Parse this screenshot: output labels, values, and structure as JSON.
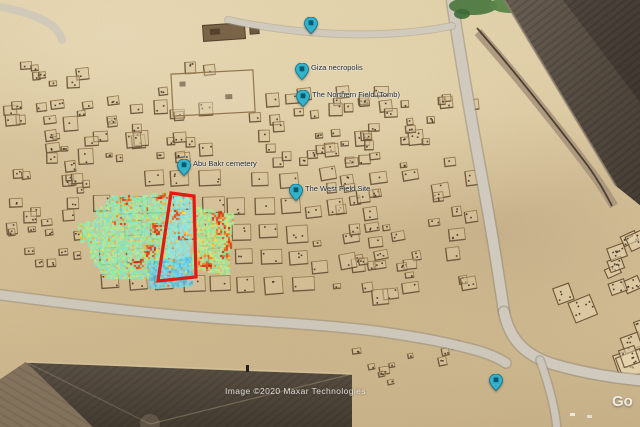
{
  "app": {
    "title": "Aerial view of the Giza plateau with geophysical survey overlay",
    "attribution": "Image ©2020 Maxar Technologies",
    "watermark_partial": "Go"
  },
  "colors": {
    "sand": "#d7c39a",
    "survey_outline": "#e51a14",
    "pin_fill": "#33b4cc",
    "pin_stroke": "#0d7490",
    "pin_glyph": "#0a5a72",
    "road": "#d3cdc1",
    "pyramid_dark": "#564c42",
    "heat_hot": [
      "#ffe33e",
      "#ffb01e",
      "#ff7a10",
      "#f23d0a",
      "#d41703"
    ]
  },
  "pins": [
    {
      "label": "",
      "x": 311,
      "y": 33
    },
    {
      "label": "Giza necropolis",
      "x": 302,
      "y": 79
    },
    {
      "label": "The Northern Field (Tomb)",
      "x": 303,
      "y": 106
    },
    {
      "label": "Abu Bakr cemetery",
      "x": 184,
      "y": 175
    },
    {
      "label": "The West Field Site",
      "x": 296,
      "y": 200
    },
    {
      "label": "",
      "x": 496,
      "y": 390
    }
  ],
  "scene": {
    "seed": 7,
    "survey_outline_points": [
      [
        171,
        193
      ],
      [
        194,
        196
      ],
      [
        196,
        277
      ],
      [
        158,
        281
      ]
    ],
    "heatmap_patches": [
      {
        "poly": [
          [
            113,
            196
          ],
          [
            171,
            193
          ],
          [
            170,
            266
          ],
          [
            152,
            267
          ],
          [
            150,
            280
          ],
          [
            106,
            279
          ],
          [
            90,
            258
          ],
          [
            88,
            235
          ],
          [
            97,
            210
          ]
        ],
        "base": [
          "#8ceea2",
          "#9df2ae",
          "#7fe9d6",
          "#b2f2a0"
        ],
        "base_hot": 0.06,
        "boost": 0.5,
        "clusters": [
          [
            156,
            228
          ],
          [
            149,
            250
          ],
          [
            126,
            197
          ],
          [
            160,
            196
          ],
          [
            136,
            262
          ],
          [
            118,
            221
          ]
        ]
      },
      {
        "poly": [
          [
            171,
            196
          ],
          [
            193,
            198
          ],
          [
            190,
            271
          ],
          [
            166,
            268
          ]
        ],
        "base": [
          "#7fe9ea",
          "#8defe3",
          "#9ef2d2",
          "#8be4ef"
        ],
        "base_hot": 0.05,
        "boost": 0.3,
        "clusters": [
          [
            180,
            236
          ],
          [
            175,
            214
          ]
        ]
      },
      {
        "poly": [
          [
            147,
            261
          ],
          [
            195,
            257
          ],
          [
            192,
            286
          ],
          [
            149,
            289
          ]
        ],
        "base": [
          "#46bce2",
          "#58cae9",
          "#6cd6ee",
          "#7fe0f0"
        ],
        "base_hot": 0.04,
        "boost": 0.22,
        "clusters": [
          [
            170,
            272
          ]
        ]
      },
      {
        "poly": [
          [
            196,
            207
          ],
          [
            234,
            214
          ],
          [
            229,
            276
          ],
          [
            192,
            269
          ]
        ],
        "base": [
          "#8ceea2",
          "#aff09b",
          "#c8f08c"
        ],
        "base_hot": 0.14,
        "boost": 0.55,
        "clusters": [
          [
            222,
            230
          ],
          [
            226,
            255
          ],
          [
            205,
            262
          ],
          [
            218,
            216
          ],
          [
            230,
            243
          ]
        ]
      },
      {
        "poly": [
          [
            78,
            224
          ],
          [
            90,
            221
          ],
          [
            92,
            240
          ],
          [
            80,
            243
          ]
        ],
        "base": [
          "#8ceea2",
          "#9df2ae"
        ],
        "base_hot": 0.03,
        "boost": 0.2,
        "clusters": [
          [
            85,
            232
          ]
        ]
      }
    ],
    "mastaba_clusters": [
      {
        "type": "grid",
        "x": 90,
        "y": 170,
        "cols": 8,
        "rows": 5,
        "dx": 27,
        "dy": 26,
        "w": 19,
        "h": 15,
        "rot": -3,
        "row_shift": 3,
        "skip": 0.12
      },
      {
        "type": "scatter",
        "x": 2,
        "y": 58,
        "w": 225,
        "h": 100,
        "count": 48,
        "min": 6,
        "max": 15,
        "rot": -5
      },
      {
        "type": "scatter",
        "x": 2,
        "y": 150,
        "w": 82,
        "h": 112,
        "count": 26,
        "min": 6,
        "max": 13,
        "rot": -4
      },
      {
        "type": "scatter",
        "x": 232,
        "y": 84,
        "w": 235,
        "h": 80,
        "count": 52,
        "min": 6,
        "max": 15,
        "rot": -4
      },
      {
        "type": "scatter",
        "x": 305,
        "y": 165,
        "w": 162,
        "h": 130,
        "count": 48,
        "min": 7,
        "max": 17,
        "rot": -8
      },
      {
        "type": "scatter",
        "x": 352,
        "y": 332,
        "w": 112,
        "h": 55,
        "count": 10,
        "min": 5,
        "max": 10,
        "rot": -10
      },
      {
        "type": "big",
        "x": 545,
        "y": 282,
        "w": 95,
        "h": 78,
        "count": 9,
        "min": 15,
        "max": 30,
        "rot": -22
      },
      {
        "type": "big",
        "x": 598,
        "y": 228,
        "w": 42,
        "h": 56,
        "count": 5,
        "min": 12,
        "max": 22,
        "rot": -22
      }
    ]
  }
}
